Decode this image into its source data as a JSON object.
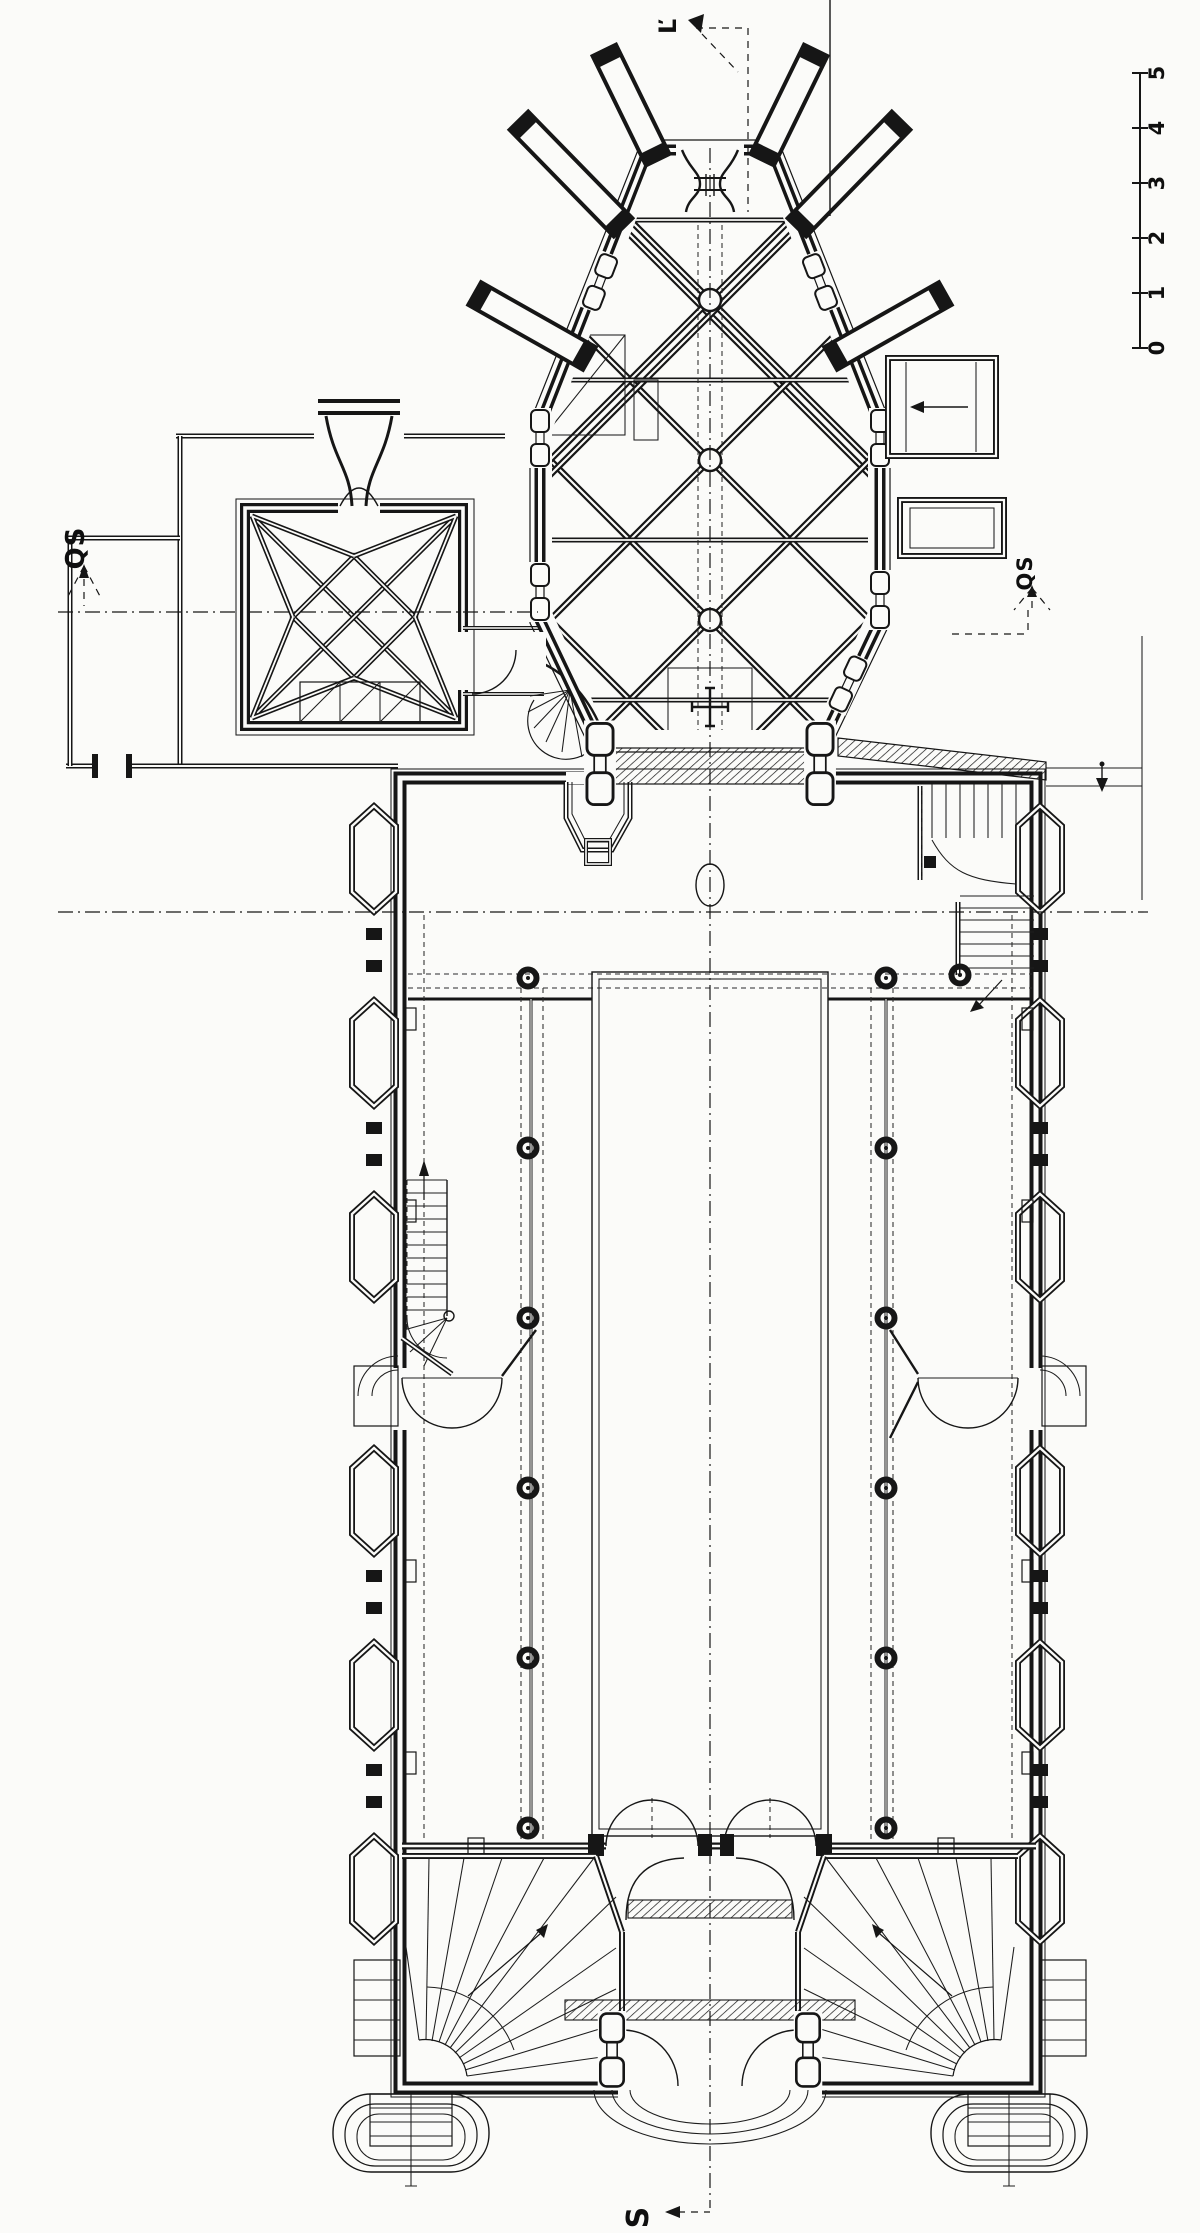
{
  "page": {
    "paper_color": "#fbfbf9",
    "ink_color": "#161616"
  },
  "annotations": {
    "section_top": "Ľ",
    "section_left": "QS",
    "section_right": "QS",
    "section_bottom": "S"
  },
  "scale_bar": {
    "ticks": [
      "0",
      "1",
      "2",
      "3",
      "4",
      "5"
    ]
  }
}
